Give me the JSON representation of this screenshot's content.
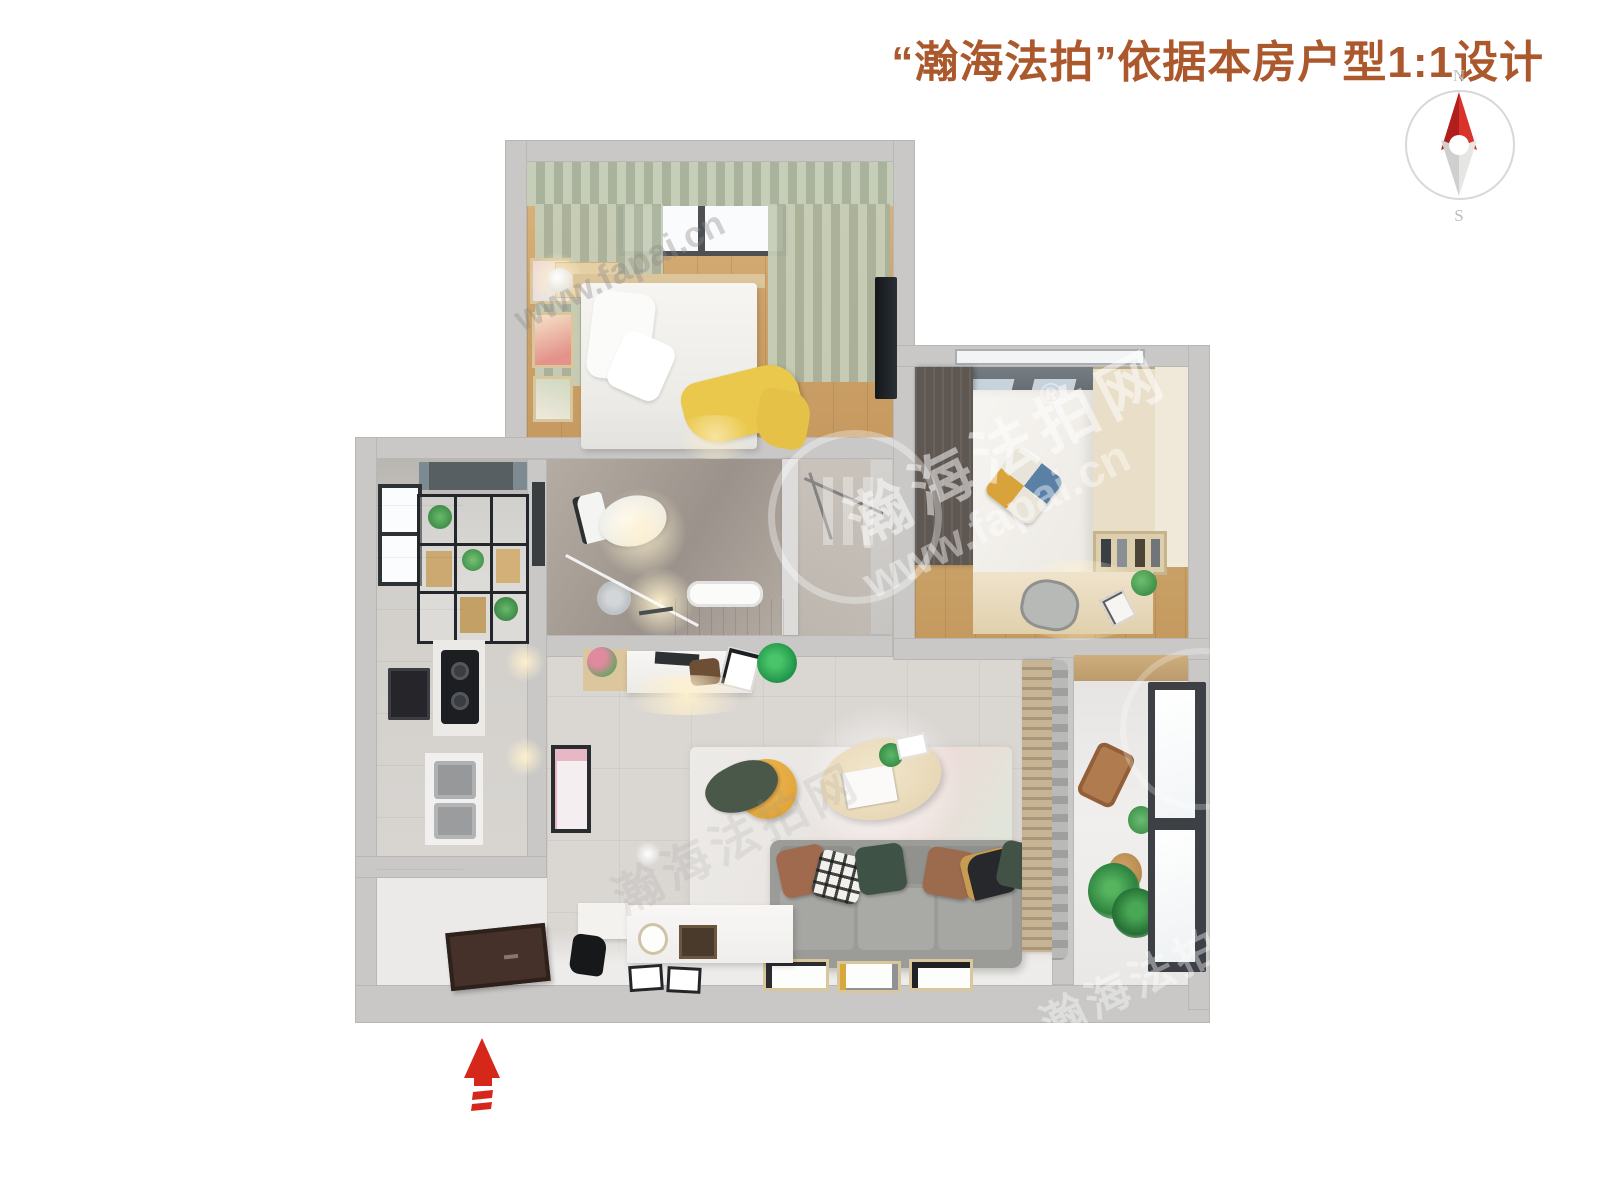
{
  "header": {
    "title": "“瀚海法拍”依据本房户型1:1设计",
    "title_color": "#ab582c"
  },
  "compass": {
    "north_label": "N",
    "south_label": "S",
    "needle_north_color": "#c8251f",
    "needle_south_color": "#d9d9d7",
    "ring_color": "#d8d8d8"
  },
  "watermark": {
    "site_name": "瀚海法拍网",
    "url": "www.fapai.cn",
    "registered_mark": "®"
  },
  "entrance": {
    "icon": "entrance-arrow",
    "arrow_color": "#d6281a"
  },
  "palette": {
    "wall": "#c9c8c6",
    "bedroom_wood_floor": "#d3ab74",
    "second_bedroom_wood_floor": "#c9a066",
    "living_tile_floor": "#dad6d2",
    "bathroom_marble": "#a89f96",
    "kitchen_floor": "#cfccc8",
    "balcony_floor": "#edecea",
    "curtain_sage": "#b6bfab",
    "sofa_gray": "#9b9b98",
    "pouf_yellow": "#e7a93e",
    "bed_throw_yellow": "#e9c84b",
    "coffee_table_wood": "#ecdfc3",
    "dark_wardrobe": "#5f5751"
  }
}
